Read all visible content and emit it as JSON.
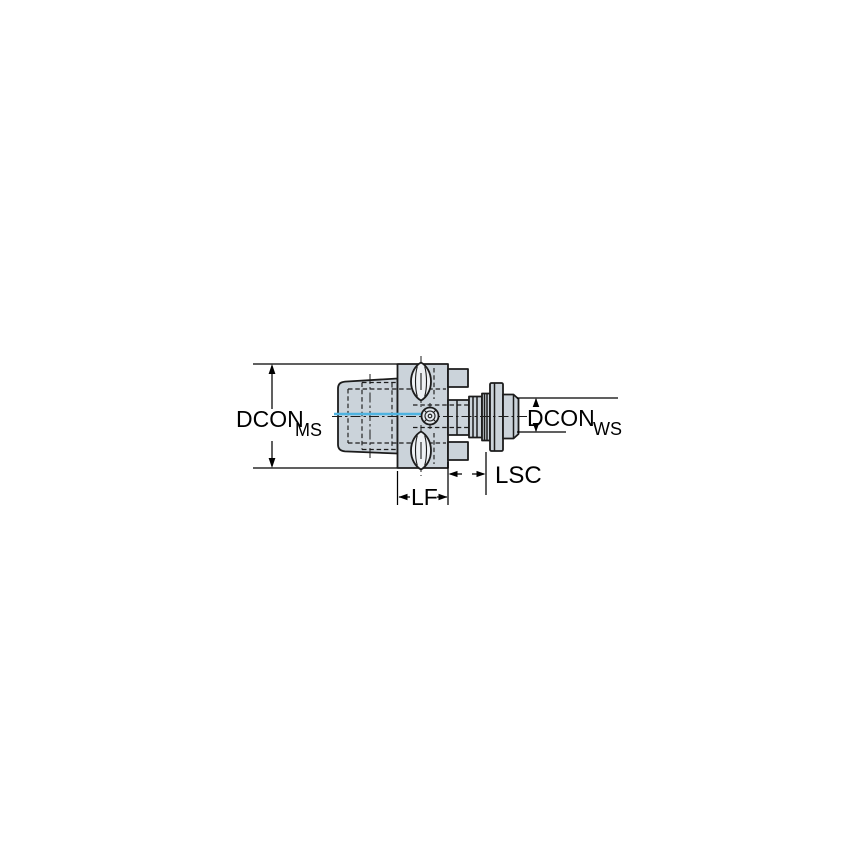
{
  "page": {
    "background": "#ffffff"
  },
  "drawing": {
    "kind": "tool-adapter-side-view-technical-drawing",
    "labels": {
      "dcon_ms_main": "DCON",
      "dcon_ms_sub": "MS",
      "dcon_ws_main": "DCON",
      "dcon_ws_sub": "WS",
      "lsc": "LSC",
      "lf": "LF"
    },
    "colors": {
      "metal_fill": "#cbd3da",
      "slot_fill": "#eef1f4",
      "screw_fill": "#e3e8ed",
      "outline": "#1c1c1c",
      "dimension_line": "#000000",
      "coolant_line": "#4fb3e0"
    }
  }
}
